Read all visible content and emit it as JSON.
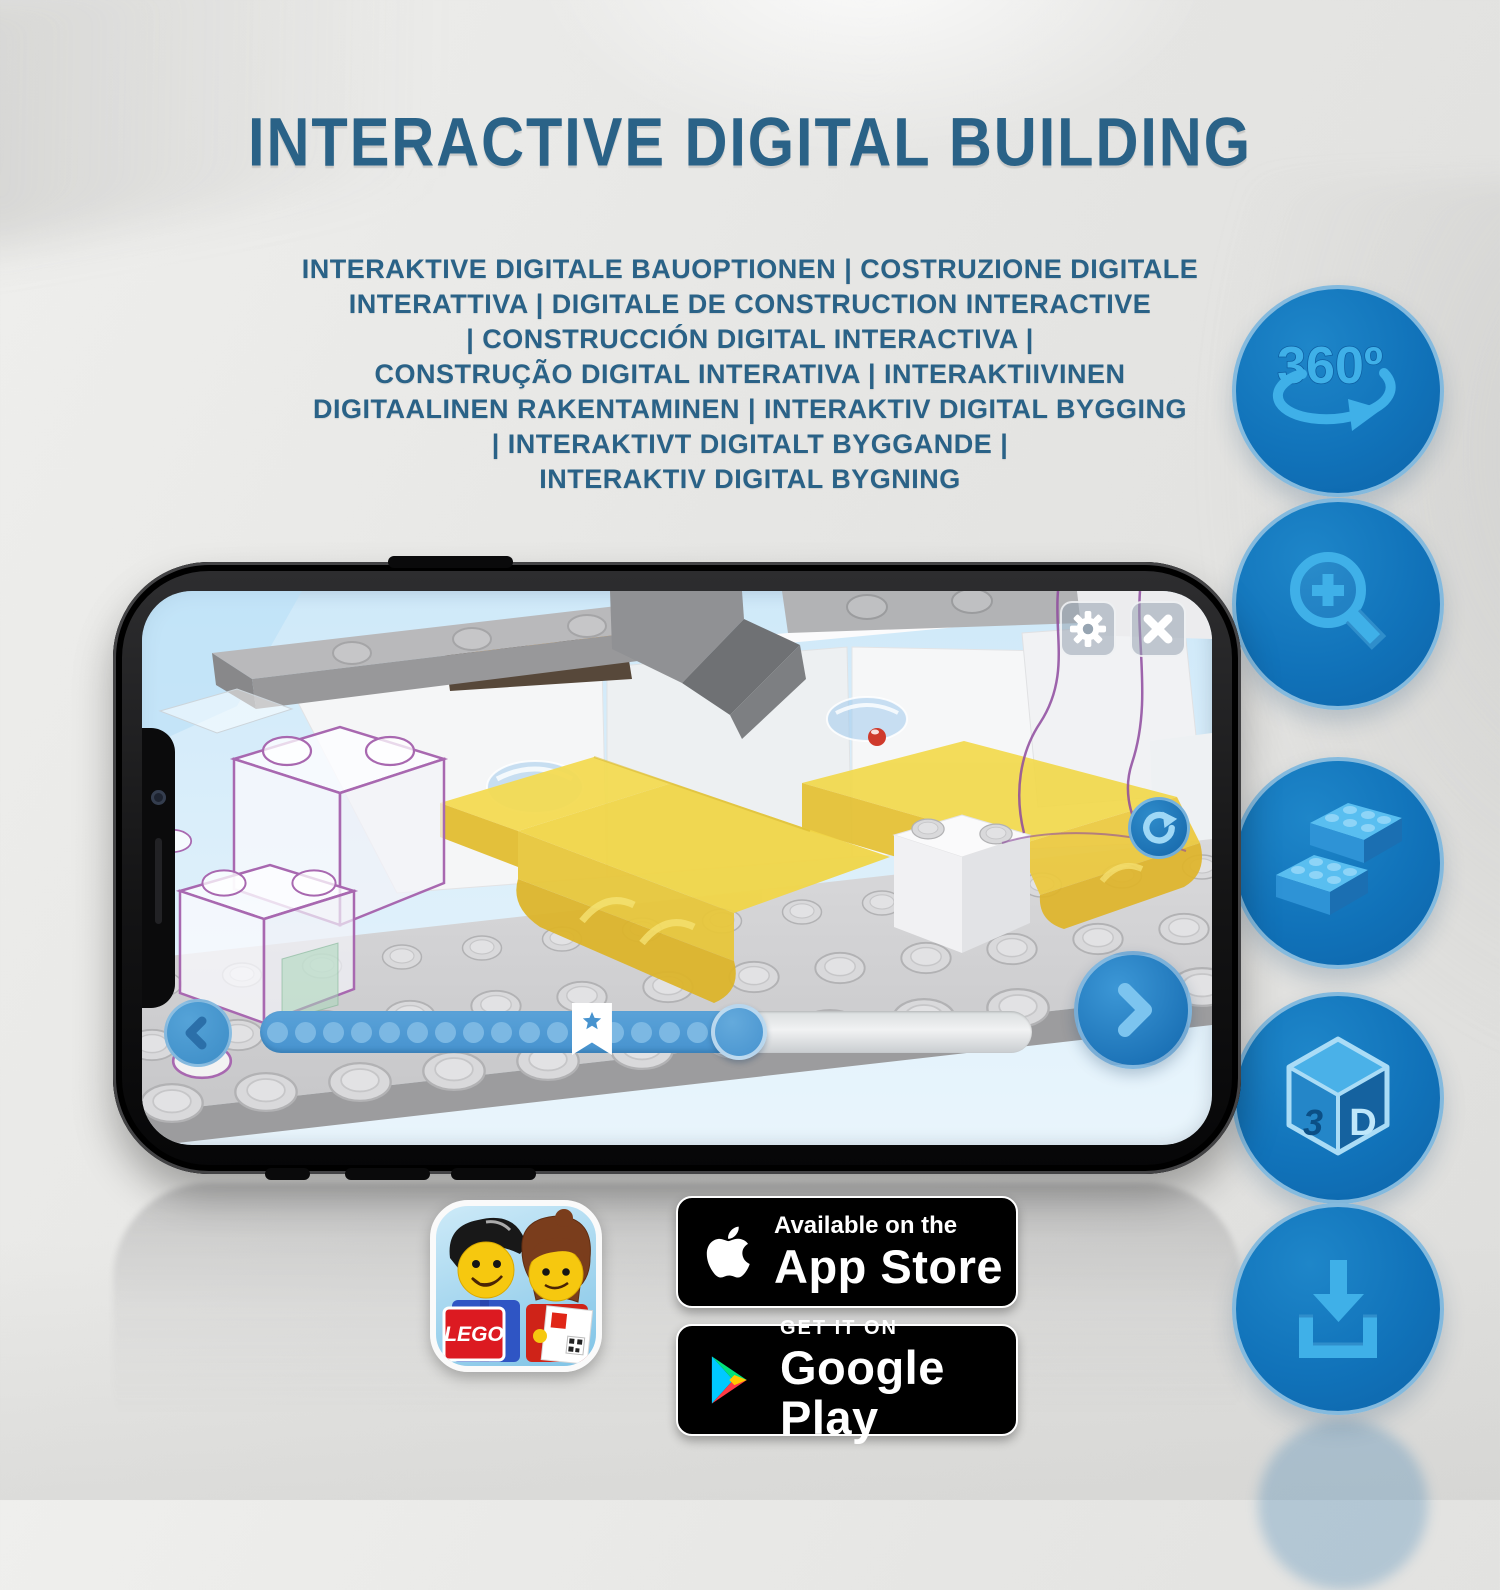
{
  "header": {
    "title": "INTERACTIVE DIGITAL BUILDING",
    "subtitle_lines": [
      "INTERAKTIVE DIGITALE BAUOPTIONEN | COSTRUZIONE DIGITALE",
      "INTERATTIVA | DIGITALE DE CONSTRUCTION INTERACTIVE",
      "| CONSTRUCCIÓN DIGITAL INTERACTIVA |",
      "CONSTRUÇÃO DIGITAL INTERATIVA | INTERAKTIIVINEN",
      "DIGITAALINEN RAKENTAMINEN | INTERAKTIV DIGITAL BYGGING",
      "| INTERAKTIVT DIGITALT BYGGANDE |",
      "INTERAKTIV DIGITAL BYGNING"
    ]
  },
  "feature_icons": {
    "rotate360": {
      "label": "360º",
      "name": "360-rotation-icon"
    },
    "zoom": {
      "name": "zoom-in-icon"
    },
    "bricks": {
      "name": "brick-stack-icon"
    },
    "cube3d": {
      "name": "3d-cube-icon",
      "face_left": "3",
      "face_right": "D"
    },
    "download": {
      "name": "download-icon"
    }
  },
  "phone": {
    "slider": {
      "progress_percent": 62,
      "bookmark_percent": 43,
      "dot_count": 17
    }
  },
  "store_badges": {
    "lego_app": {
      "logo_text": "LEGO"
    },
    "app_store": {
      "line1": "Available on the",
      "line2": "App Store"
    },
    "google_play": {
      "line1": "GET IT ON",
      "line2": "Google Play"
    }
  },
  "colors": {
    "title_blue": "#2a6287",
    "circle_blue": "#1173ba",
    "icon_light_blue": "#45b3e9",
    "slider_blue": "#4793cf",
    "lego_yellow": "#f1d647"
  }
}
